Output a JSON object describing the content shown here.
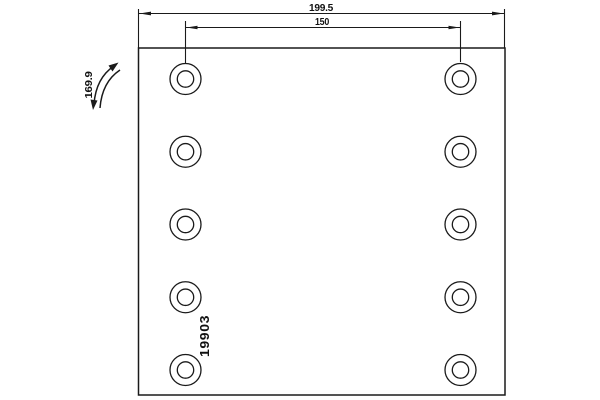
{
  "drawing": {
    "kind": "technical-part-drawing",
    "colors": {
      "background": "#ffffff",
      "line": "#1a1a1a",
      "text": "#111111"
    },
    "dimensions": {
      "total_width": "199.5",
      "hole_pitch": "150"
    },
    "curvature": {
      "radius": "169.9"
    },
    "part": {
      "number": "19903"
    },
    "holes": {
      "columns": 2,
      "rows": 5,
      "count": 10
    }
  }
}
